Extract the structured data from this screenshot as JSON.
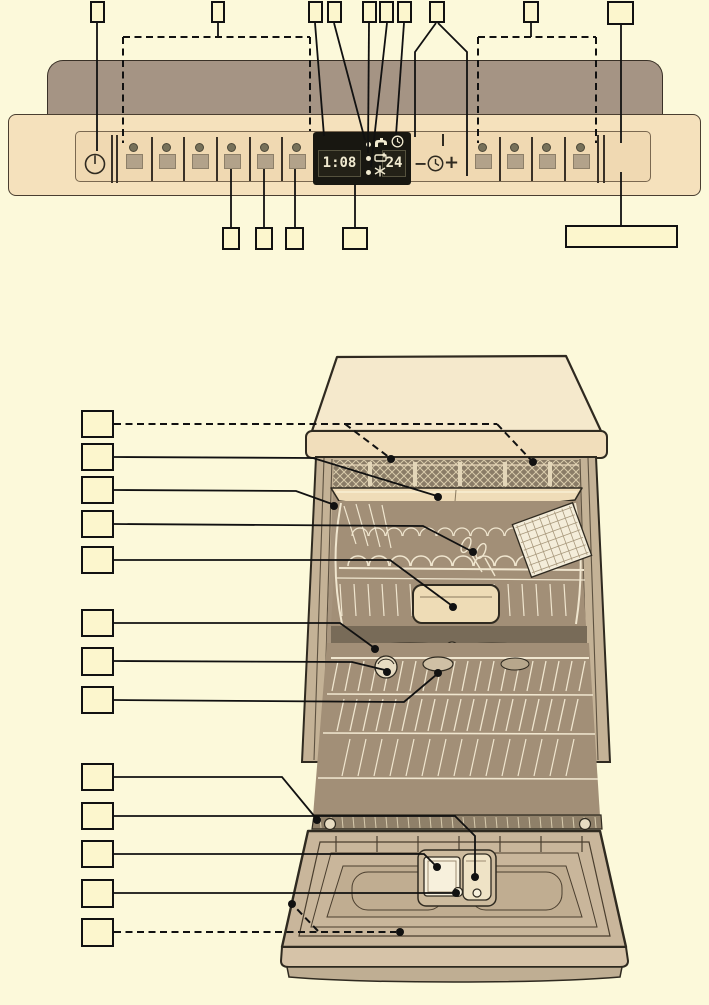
{
  "page": {
    "background": "#fcf9da",
    "description": "dishwasher instruction diagram: control panel and interior overview",
    "line_color": "#111111"
  },
  "control_panel": {
    "power": {
      "icon": "power-icon"
    },
    "display": {
      "remaining_time": "1:08",
      "delay_hours": "24",
      "indicator_icons": [
        "water-tap-icon",
        "rinse-aid-icon",
        "salt-refill-icon"
      ],
      "clock_icon": "clock-icon"
    },
    "timer": {
      "minus": "−",
      "plus": "+",
      "clock_icon": "clock-icon"
    },
    "program_buttons": {
      "count": 6,
      "centers": [
        133,
        166,
        199,
        231,
        264,
        296
      ],
      "separators": [
        150,
        182,
        215,
        248,
        280
      ]
    },
    "option_buttons": {
      "count": 4,
      "centers": [
        482,
        514,
        546,
        580
      ],
      "separators": [
        498,
        530,
        563
      ]
    },
    "double_separators": [
      110,
      115,
      596,
      602
    ],
    "colors": {
      "panel": "#f5e1bc",
      "panel_inner": "#f0d9b2",
      "backsplash": "#a59484",
      "display_bg": "#181711",
      "digit": "#f1ead0",
      "button": "#b2a28a"
    }
  },
  "callouts": [
    {
      "id": "top-1",
      "label": "",
      "box": [
        90,
        1,
        15,
        22
      ],
      "lines": [
        {
          "pts": [
            [
              97,
              23
            ],
            [
              97,
              151
            ]
          ]
        }
      ],
      "dots": []
    },
    {
      "id": "top-2",
      "label": "",
      "box": [
        211,
        1,
        14,
        22
      ],
      "lines": [
        {
          "pts": [
            [
              218,
              23
            ],
            [
              218,
              37
            ]
          ]
        },
        {
          "pts": [
            [
              123,
              37
            ],
            [
              310,
              37
            ]
          ],
          "dashed": true
        },
        {
          "pts": [
            [
              123,
              37
            ],
            [
              123,
              143
            ]
          ],
          "dashed": true
        },
        {
          "pts": [
            [
              310,
              37
            ],
            [
              310,
              131
            ]
          ],
          "dashed": true
        }
      ],
      "dots": []
    },
    {
      "id": "top-3",
      "label": "",
      "box": [
        308,
        1,
        15,
        22
      ],
      "lines": [
        {
          "pts": [
            [
              315,
              23
            ],
            [
              324,
              136
            ]
          ]
        }
      ],
      "dots": []
    },
    {
      "id": "top-4",
      "label": "",
      "box": [
        327,
        1,
        15,
        22
      ],
      "lines": [
        {
          "pts": [
            [
              334,
              23
            ],
            [
              365,
              140
            ]
          ]
        }
      ],
      "dots": []
    },
    {
      "id": "top-5",
      "label": "",
      "box": [
        362,
        1,
        15,
        22
      ],
      "lines": [
        {
          "pts": [
            [
              369,
              23
            ],
            [
              368,
              153
            ]
          ]
        }
      ],
      "dots": []
    },
    {
      "id": "top-6",
      "label": "",
      "box": [
        379,
        1,
        15,
        22
      ],
      "lines": [
        {
          "pts": [
            [
              387,
              23
            ],
            [
              371,
              167
            ]
          ]
        }
      ],
      "dots": []
    },
    {
      "id": "top-7",
      "label": "",
      "box": [
        397,
        1,
        15,
        22
      ],
      "lines": [
        {
          "pts": [
            [
              404,
              23
            ],
            [
              396,
              135
            ]
          ]
        }
      ],
      "dots": []
    },
    {
      "id": "top-8",
      "label": "",
      "box": [
        429,
        1,
        16,
        22
      ],
      "lines": [
        {
          "pts": [
            [
              436,
              23
            ],
            [
              415,
              52
            ],
            [
              415,
              137
            ]
          ]
        },
        {
          "pts": [
            [
              438,
              23
            ],
            [
              467,
              52
            ],
            [
              467,
              176
            ]
          ]
        }
      ],
      "dots": []
    },
    {
      "id": "top-9",
      "label": "",
      "box": [
        523,
        1,
        16,
        22
      ],
      "lines": [
        {
          "pts": [
            [
              531,
              23
            ],
            [
              531,
              37
            ]
          ]
        },
        {
          "pts": [
            [
              478,
              37
            ],
            [
              596,
              37
            ]
          ],
          "dashed": true
        },
        {
          "pts": [
            [
              478,
              37
            ],
            [
              478,
              143
            ]
          ],
          "dashed": true
        },
        {
          "pts": [
            [
              596,
              37
            ],
            [
              596,
              143
            ]
          ],
          "dashed": true
        }
      ],
      "dots": []
    },
    {
      "id": "top-10",
      "label": "",
      "box": [
        607,
        1,
        27,
        24
      ],
      "lines": [
        {
          "pts": [
            [
              621,
              25
            ],
            [
              621,
              143
            ]
          ]
        }
      ],
      "dots": []
    },
    {
      "id": "bottom-1",
      "label": "",
      "box": [
        222,
        227,
        18,
        23
      ],
      "lines": [
        {
          "pts": [
            [
              231,
              169
            ],
            [
              231,
              227
            ]
          ]
        }
      ],
      "dots": []
    },
    {
      "id": "bottom-2",
      "label": "",
      "box": [
        255,
        227,
        18,
        23
      ],
      "lines": [
        {
          "pts": [
            [
              264,
              169
            ],
            [
              264,
              227
            ]
          ]
        }
      ],
      "dots": []
    },
    {
      "id": "bottom-3",
      "label": "",
      "box": [
        285,
        227,
        19,
        23
      ],
      "lines": [
        {
          "pts": [
            [
              295,
              169
            ],
            [
              295,
              227
            ]
          ]
        }
      ],
      "dots": []
    },
    {
      "id": "bottom-4",
      "label": "",
      "box": [
        342,
        227,
        26,
        23
      ],
      "lines": [
        {
          "pts": [
            [
              355,
              184
            ],
            [
              355,
              227
            ]
          ]
        }
      ],
      "dots": []
    },
    {
      "id": "bottom-5",
      "label": "",
      "box": [
        565,
        225,
        113,
        23
      ],
      "lines": [
        {
          "pts": [
            [
              621,
              172
            ],
            [
              621,
              225
            ]
          ]
        }
      ],
      "dots": []
    },
    {
      "id": "left-1",
      "label": "",
      "box": [
        81,
        410,
        33,
        28
      ],
      "lines": [
        {
          "pts": [
            [
              114,
              424
            ],
            [
              497,
              424
            ]
          ],
          "dashed": true
        },
        {
          "pts": [
            [
              345,
              424
            ],
            [
              390,
              458
            ]
          ],
          "dashed": true
        },
        {
          "pts": [
            [
              497,
              424
            ],
            [
              532,
              461
            ]
          ],
          "dashed": true
        }
      ],
      "dots": [
        [
          391,
          459
        ],
        [
          533,
          462
        ]
      ]
    },
    {
      "id": "left-2",
      "label": "",
      "box": [
        81,
        443,
        33,
        28
      ],
      "lines": [
        {
          "pts": [
            [
              114,
              457
            ],
            [
              313,
              458
            ],
            [
              437,
              496
            ]
          ]
        }
      ],
      "dots": [
        [
          438,
          497
        ]
      ]
    },
    {
      "id": "left-3",
      "label": "",
      "box": [
        81,
        476,
        33,
        28
      ],
      "lines": [
        {
          "pts": [
            [
              114,
              490
            ],
            [
              296,
              491
            ],
            [
              332,
              504
            ]
          ]
        }
      ],
      "dots": [
        [
          334,
          506
        ]
      ]
    },
    {
      "id": "left-4",
      "label": "",
      "box": [
        81,
        510,
        33,
        28
      ],
      "lines": [
        {
          "pts": [
            [
              114,
              524
            ],
            [
              423,
              526
            ],
            [
              471,
              551
            ]
          ]
        }
      ],
      "dots": [
        [
          473,
          552
        ]
      ]
    },
    {
      "id": "left-5",
      "label": "",
      "box": [
        81,
        546,
        33,
        28
      ],
      "lines": [
        {
          "pts": [
            [
              114,
              560
            ],
            [
              390,
              560
            ],
            [
              451,
              605
            ]
          ]
        }
      ],
      "dots": [
        [
          453,
          607
        ]
      ]
    },
    {
      "id": "left-6",
      "label": "",
      "box": [
        81,
        609,
        33,
        28
      ],
      "lines": [
        {
          "pts": [
            [
              114,
              623
            ],
            [
              340,
              623
            ],
            [
              373,
              647
            ]
          ]
        }
      ],
      "dots": [
        [
          375,
          649
        ]
      ]
    },
    {
      "id": "left-7",
      "label": "",
      "box": [
        81,
        647,
        33,
        29
      ],
      "lines": [
        {
          "pts": [
            [
              114,
              661
            ],
            [
              352,
              662
            ],
            [
              385,
              670
            ]
          ]
        }
      ],
      "dots": [
        [
          387,
          672
        ]
      ]
    },
    {
      "id": "left-8",
      "label": "",
      "box": [
        81,
        686,
        33,
        28
      ],
      "lines": [
        {
          "pts": [
            [
              114,
              700
            ],
            [
              404,
              702
            ],
            [
              436,
              675
            ]
          ]
        }
      ],
      "dots": [
        [
          438,
          673
        ]
      ]
    },
    {
      "id": "left-9",
      "label": "",
      "box": [
        81,
        763,
        33,
        28
      ],
      "lines": [
        {
          "pts": [
            [
              114,
              777
            ],
            [
              282,
              777
            ],
            [
              315,
              817
            ]
          ]
        }
      ],
      "dots": [
        [
          317,
          820
        ]
      ]
    },
    {
      "id": "left-10",
      "label": "",
      "box": [
        81,
        802,
        33,
        28
      ],
      "lines": [
        {
          "pts": [
            [
              114,
              816
            ],
            [
              455,
              816
            ],
            [
              475,
              836
            ],
            [
              475,
              874
            ]
          ]
        }
      ],
      "dots": [
        [
          475,
          877
        ]
      ]
    },
    {
      "id": "left-11",
      "label": "",
      "box": [
        81,
        840,
        33,
        28
      ],
      "lines": [
        {
          "pts": [
            [
              114,
              854
            ],
            [
              424,
              854
            ],
            [
              435,
              865
            ]
          ]
        }
      ],
      "dots": [
        [
          437,
          867
        ]
      ]
    },
    {
      "id": "left-12",
      "label": "",
      "box": [
        81,
        879,
        33,
        29
      ],
      "lines": [
        {
          "pts": [
            [
              114,
              893
            ],
            [
              453,
              893
            ]
          ]
        }
      ],
      "dots": [
        [
          456,
          893
        ]
      ]
    },
    {
      "id": "left-13",
      "label": "",
      "box": [
        81,
        918,
        33,
        29
      ],
      "lines": [
        {
          "pts": [
            [
              114,
              932
            ],
            [
              396,
              932
            ]
          ],
          "dashed": true
        },
        {
          "pts": [
            [
              318,
              931
            ],
            [
              295,
              907
            ]
          ],
          "dashed": true
        }
      ],
      "dots": [
        [
          400,
          932
        ],
        [
          292,
          904
        ]
      ]
    }
  ]
}
